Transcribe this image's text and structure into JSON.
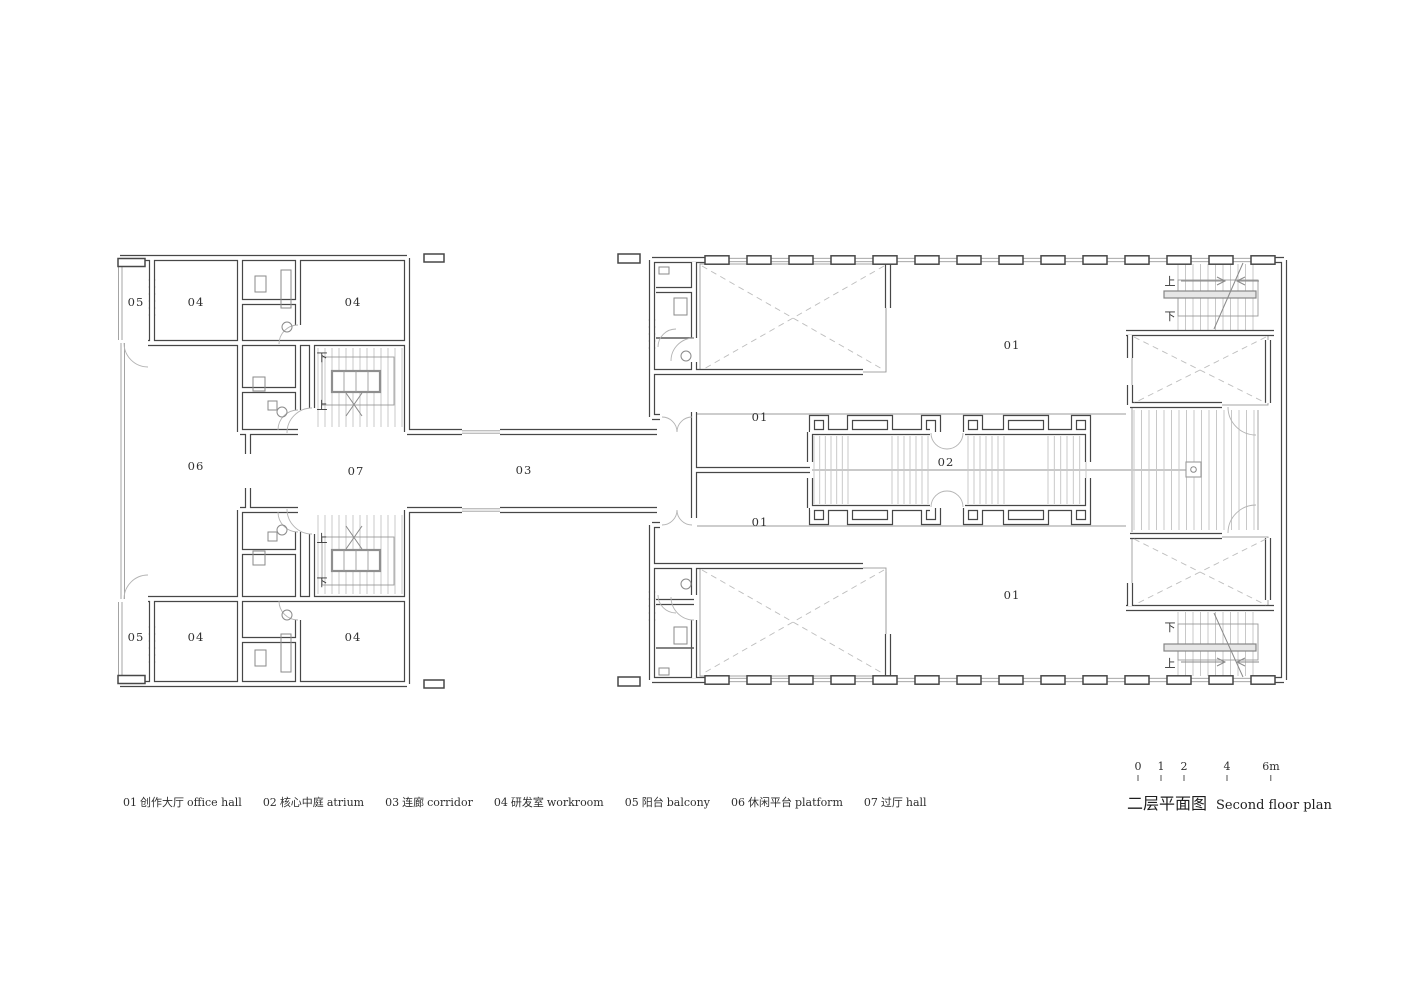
{
  "plan": {
    "room_labels": [
      {
        "room": "balcony-upper",
        "t": "05"
      },
      {
        "room": "workroom-upper-left",
        "t": "04"
      },
      {
        "room": "workroom-upper-right",
        "t": "04"
      },
      {
        "room": "platform",
        "t": "06"
      },
      {
        "room": "hall-passage",
        "t": "07"
      },
      {
        "room": "corridor",
        "t": "03"
      },
      {
        "room": "balcony-lower",
        "t": "05"
      },
      {
        "room": "workroom-lower-left",
        "t": "04"
      },
      {
        "room": "workroom-lower-right",
        "t": "04"
      },
      {
        "room": "office-hall-entry-upper",
        "t": "01"
      },
      {
        "room": "office-hall-entry-lower",
        "t": "01"
      },
      {
        "room": "office-hall-upper",
        "t": "01"
      },
      {
        "room": "office-hall-lower",
        "t": "01"
      },
      {
        "room": "atrium",
        "t": "02"
      }
    ],
    "stair_up": "上",
    "stair_down": "下"
  },
  "legend": {
    "items": [
      {
        "num": "01",
        "zh": "创作大厅",
        "en": "office hall"
      },
      {
        "num": "02",
        "zh": "核心中庭",
        "en": "atrium"
      },
      {
        "num": "03",
        "zh": "连廊",
        "en": "corridor"
      },
      {
        "num": "04",
        "zh": "研发室",
        "en": "workroom"
      },
      {
        "num": "05",
        "zh": "阳台",
        "en": "balcony"
      },
      {
        "num": "06",
        "zh": "休闲平台",
        "en": "platform"
      },
      {
        "num": "07",
        "zh": "过厅",
        "en": "hall"
      }
    ]
  },
  "titleblock": {
    "title_zh": "二层平面图",
    "title_en": "Second floor plan",
    "scale_ticks": [
      "0",
      "1",
      "2",
      "4",
      "6m"
    ]
  },
  "colors": {
    "wall": "#474747",
    "thin_line": "#9b9b9b",
    "dashed_void": "#bdbdbd",
    "text": "#303030"
  }
}
